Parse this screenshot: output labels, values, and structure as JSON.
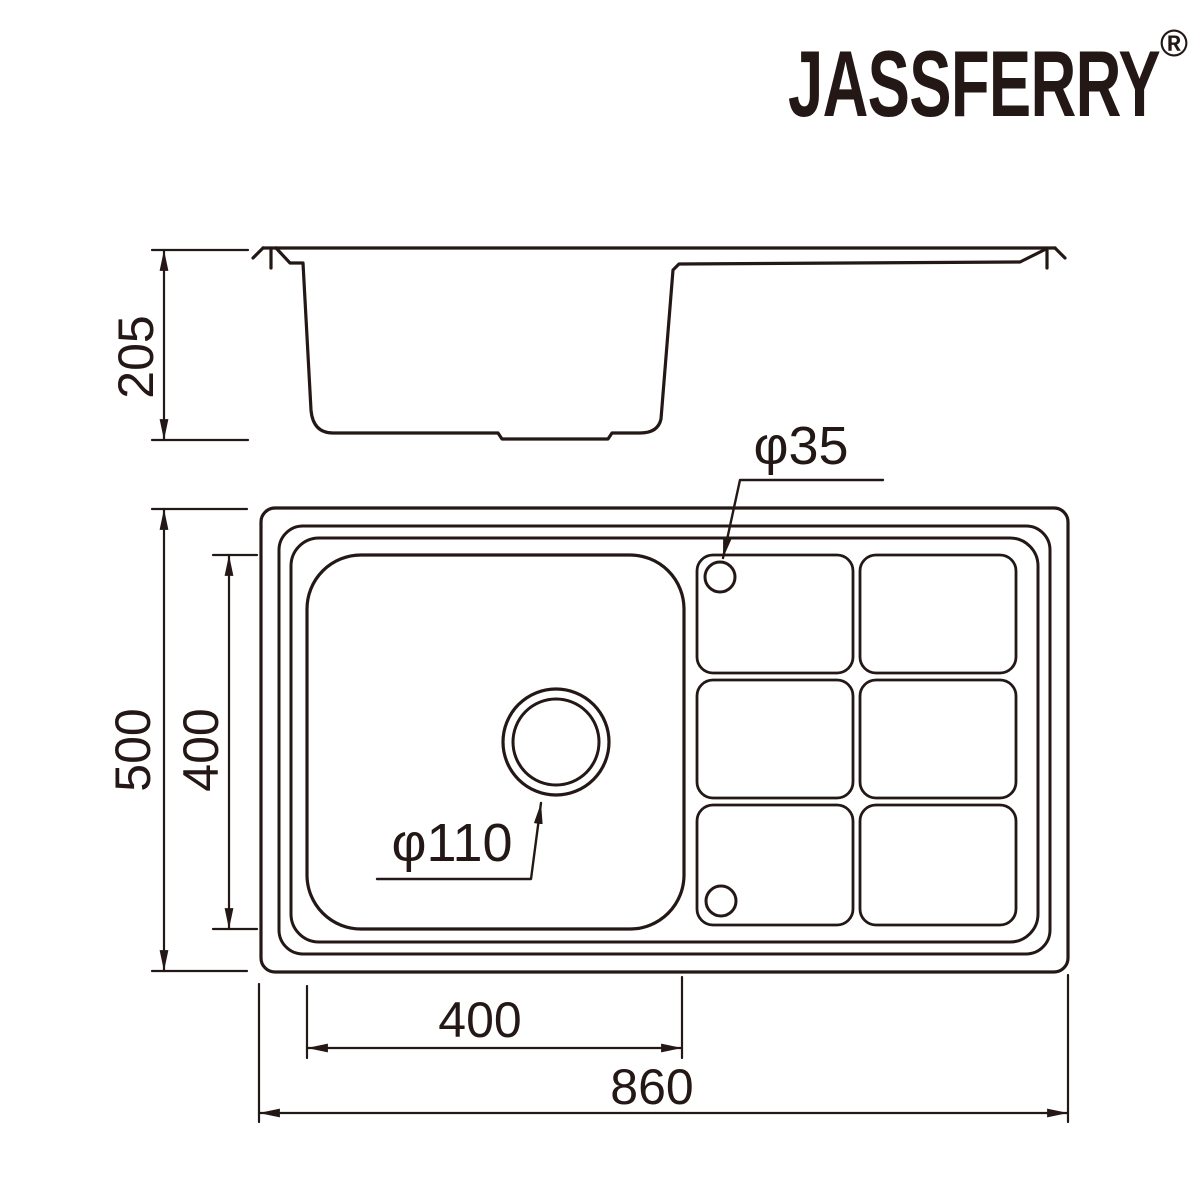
{
  "brand": {
    "name": "JASSFERRY",
    "registered_mark": "®"
  },
  "side_view": {
    "depth": "205"
  },
  "top_view": {
    "overall_height": "500",
    "bowl_height": "400",
    "tap_hole_diameter": "φ35",
    "drain_diameter": "φ110",
    "bowl_width": "400",
    "overall_width": "860"
  },
  "colors": {
    "line": "#231815",
    "background": "#ffffff"
  }
}
